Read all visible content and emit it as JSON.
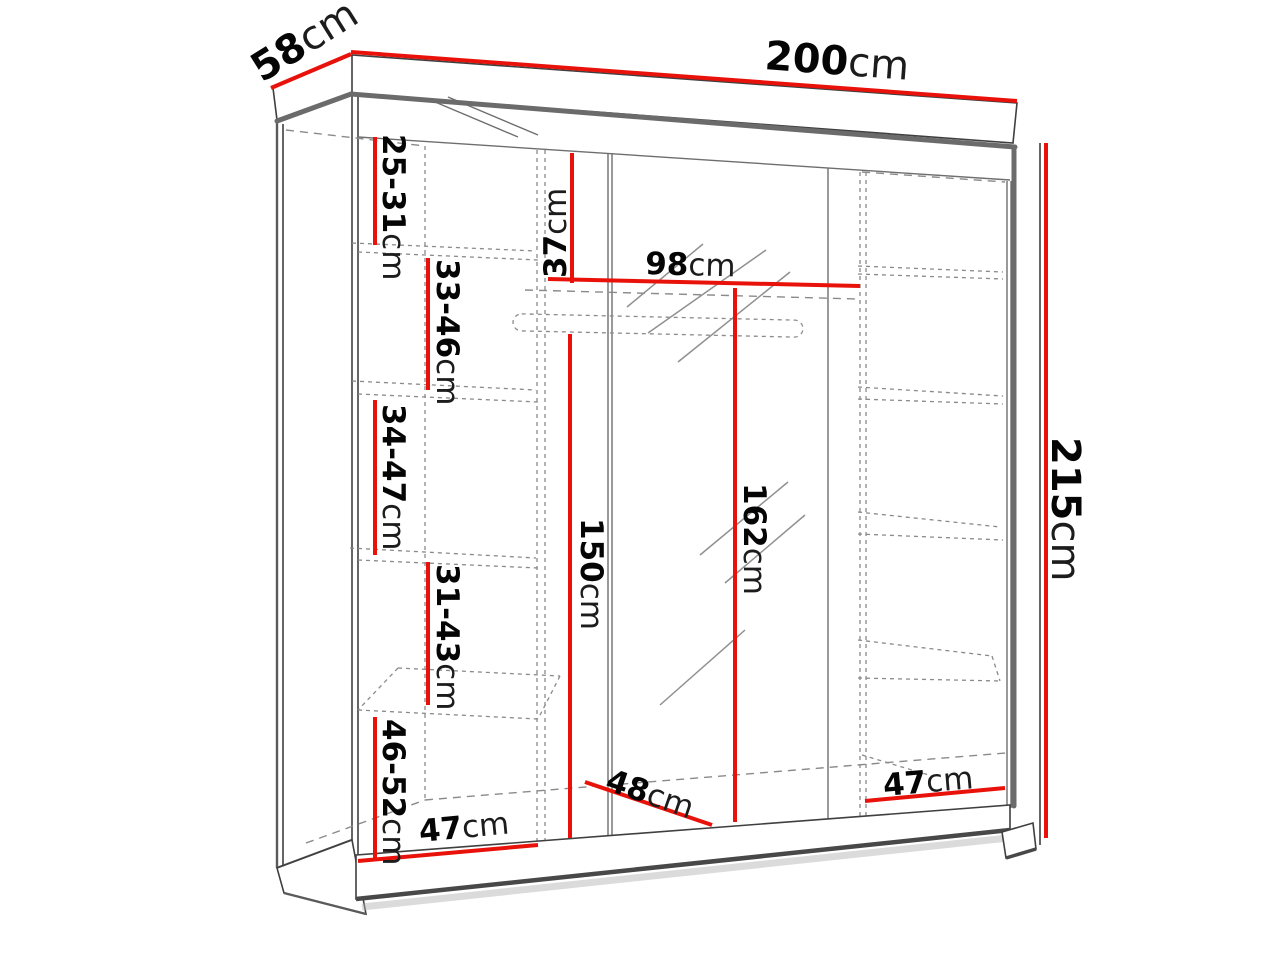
{
  "title": "Wardrobe dimensions diagram",
  "unit": "cm",
  "colors": {
    "dimension_red": "#e8120b",
    "outline_gray": "#3f3f3f",
    "dashed_gray": "#8a8a8a"
  },
  "labels": {
    "width": {
      "num": "200",
      "unit": "cm"
    },
    "depth": {
      "num": "58",
      "unit": "cm"
    },
    "height": {
      "num": "215",
      "unit": "cm"
    },
    "top_gap": {
      "num": "25-31",
      "unit": "cm"
    },
    "rail_drop": {
      "num": "37",
      "unit": "cm"
    },
    "mid_width": {
      "num": "98",
      "unit": "cm"
    },
    "gap_33_46": {
      "num": "33-46",
      "unit": "cm"
    },
    "gap_34_47": {
      "num": "34-47",
      "unit": "cm"
    },
    "hang_height": {
      "num": "150",
      "unit": "cm"
    },
    "mid_height": {
      "num": "162",
      "unit": "cm"
    },
    "gap_31_43": {
      "num": "31-43",
      "unit": "cm"
    },
    "gap_46_52": {
      "num": "46-52",
      "unit": "cm"
    },
    "mid_depth": {
      "num": "48",
      "unit": "cm"
    },
    "left_width": {
      "num": "47",
      "unit": "cm"
    },
    "right_width": {
      "num": "47",
      "unit": "cm"
    }
  }
}
